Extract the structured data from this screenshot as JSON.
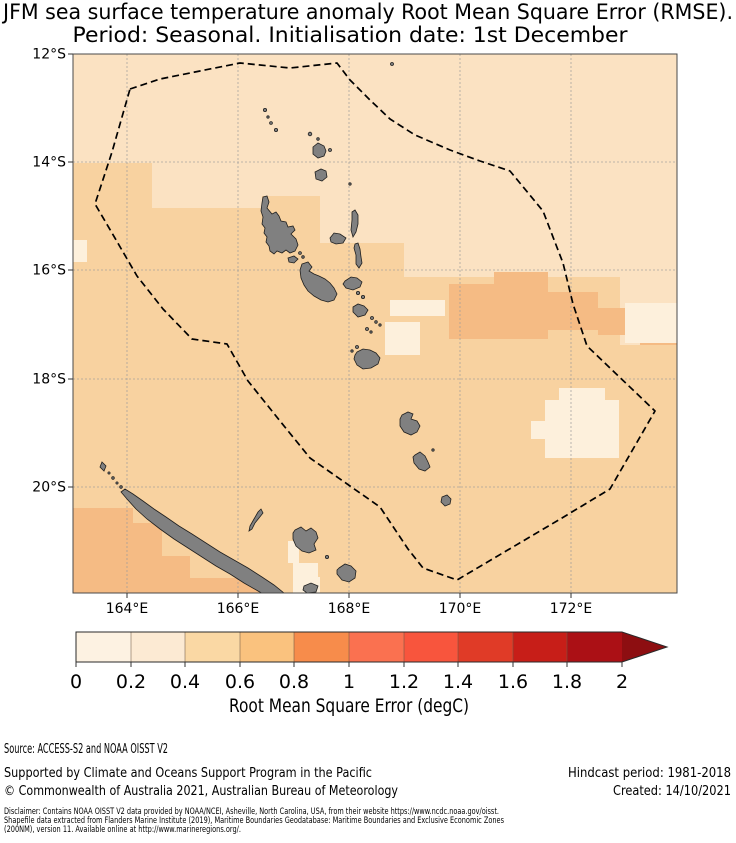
{
  "title": {
    "line1": "JFM sea surface temperature anomaly Root Mean Square Error (RMSE).",
    "line2": "Period: Seasonal. Initialisation date: 1st December"
  },
  "map": {
    "lat_labels": [
      "12°S",
      "14°S",
      "16°S",
      "18°S",
      "20°S"
    ],
    "lon_labels": [
      "164°E",
      "166°E",
      "168°E",
      "170°E",
      "172°E"
    ],
    "palette": {
      "rmse_0_02": "#fdf0dc",
      "rmse_02_04": "#fbe2c2",
      "rmse_04_06": "#f8d2a0",
      "rmse_06_08": "#f5bb84"
    },
    "island_fill": "#808080",
    "eez_color": "#000000"
  },
  "colorbar": {
    "ticks": [
      "0",
      "0.2",
      "0.4",
      "0.6",
      "0.8",
      "1",
      "1.2",
      "1.4",
      "1.6",
      "1.8",
      "2"
    ],
    "label": "Root Mean Square Error (degC)",
    "segment_colors": [
      "#fdf2e2",
      "#fcead3",
      "#fad8a4",
      "#fac27e",
      "#f78c4b",
      "#fa7150",
      "#f8553d",
      "#e03b27",
      "#c71e18",
      "#ab1015"
    ],
    "arrow_color": "#8d0e11"
  },
  "footer": {
    "source": "Source: ACCESS-S2 and NOAA OISST V2",
    "supported": "Supported by Climate and Oceans Support Program in the Pacific",
    "copyright": "© Commonwealth of Australia 2021, Australian Bureau of Meteorology",
    "hindcast": "Hindcast period: 1981-2018",
    "created": "Created: 14/10/2021",
    "disclaimer_lines": [
      "Disclaimer: Contains NOAA OISST V2 data provided by NOAA/NCEI, Asheville, North Carolina, USA, from their website https://www.ncdc.noaa.gov/oisst.",
      "Shapefile data extracted from Flanders Marine Institute (2019), Maritime Boundaries Geodatabase: Maritime Boundaries and Exclusive Economic Zones",
      "(200NM), version 11. Available online at http://www.marineregions.org/."
    ]
  }
}
